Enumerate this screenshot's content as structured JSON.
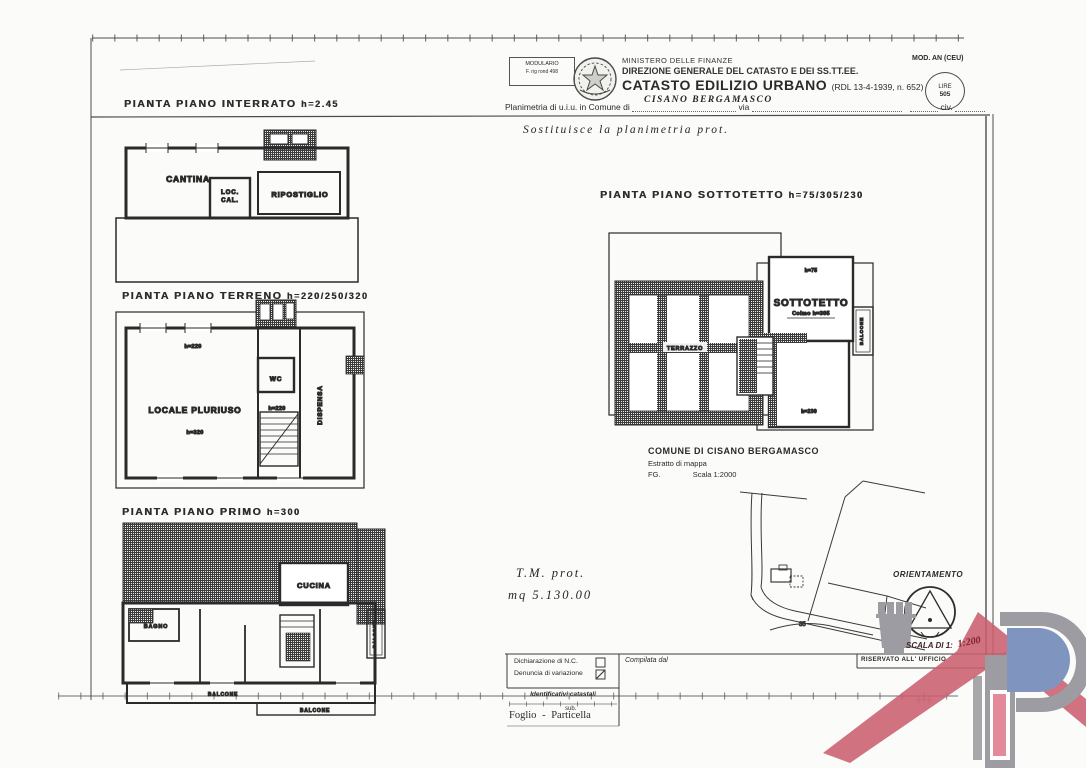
{
  "colors": {
    "ink": "#2e2e2e",
    "logo_grey": "#9c9ca2",
    "logo_red": "#c95f6e",
    "logo_pink": "#e2899a",
    "logo_blue": "#8094c0"
  },
  "header": {
    "modulario_line1": "MODULARIO",
    "modulario_line2": "F. rig rond 498",
    "ministero": "MINISTERO DELLE FINANZE",
    "direzione": "DIREZIONE GENERALE DEL CATASTO E DEI SS.TT.EE.",
    "catasto": "CATASTO EDILIZIO URBANO",
    "rdl": "(RDL 13-4-1939, n. 652)",
    "mod_an": "MOD. AN (CEU)",
    "lire_line1": "LIRE",
    "lire_line2": "505",
    "planimetria_prefix": "Planimetria di u.i.u. in Comune di",
    "comune_handwritten": "CISANO BERGAMASCO",
    "via_label": "via",
    "civ_label": "civ."
  },
  "handwriting": {
    "sostituisce": "Sostituisce la planimetria prot.",
    "tm_prot": "T.M. prot.",
    "mq": "mq 5.130.00",
    "scala_value": "1:200"
  },
  "plans": {
    "interrato": {
      "title": "PIANTA PIANO INTERRATO",
      "height": "h=2.45",
      "rooms": {
        "cantina": "CANTINA",
        "loc_cal_line1": "LOC.",
        "loc_cal_line2": "CAL.",
        "ripostiglio": "RIPOSTIGLIO"
      }
    },
    "terreno": {
      "title": "PIANTA PIANO TERRENO",
      "height": "h=220/250/320",
      "rooms": {
        "locale_pluriuso": "LOCALE PLURIUSO",
        "wc": "WC",
        "dispensa": "DISPENSA"
      },
      "annotations": {
        "top": "h=220",
        "mid": "h=320",
        "stairs": "h=220"
      }
    },
    "primo": {
      "title": "PIANTA PIANO PRIMO",
      "height": "h=300",
      "rooms": {
        "bagno": "BAGNO",
        "cucina": "CUCINA",
        "balcone_1": "BALCONE",
        "balcone_2": "BALCONE",
        "balcone_3": "BALCONE"
      }
    },
    "sottotetto": {
      "title": "PIANTA PIANO SOTTOTETTO",
      "height": "h=75/305/230",
      "rooms": {
        "terrazzo": "TERRAZZO",
        "sottotetto": "SOTTOTETTO",
        "balcone": "BALCONE"
      },
      "annotations": {
        "h75": "h=75",
        "colmo": "Colmo h=305",
        "h230": "h=230"
      }
    }
  },
  "map_extract": {
    "comune": "COMUNE DI CISANO BERGAMASCO",
    "estratto": "Estratto di mappa",
    "fg": "FG.",
    "scala": "Scala 1:2000",
    "parcel": "35"
  },
  "orientation": {
    "label": "ORIENTAMENTO",
    "scala_label": "SCALA DI 1:"
  },
  "form": {
    "dichiarazione": "Dichiarazione di N.C.",
    "denuncia": "Denuncia di variazione",
    "compilata": "Compilata dal",
    "identificativi": "Identificativi catastali",
    "sub": "sub.",
    "foglio": "Foglio",
    "dash": "-",
    "particella": "Particella",
    "riservato": "RISERVATO ALL' UFFICIO"
  }
}
